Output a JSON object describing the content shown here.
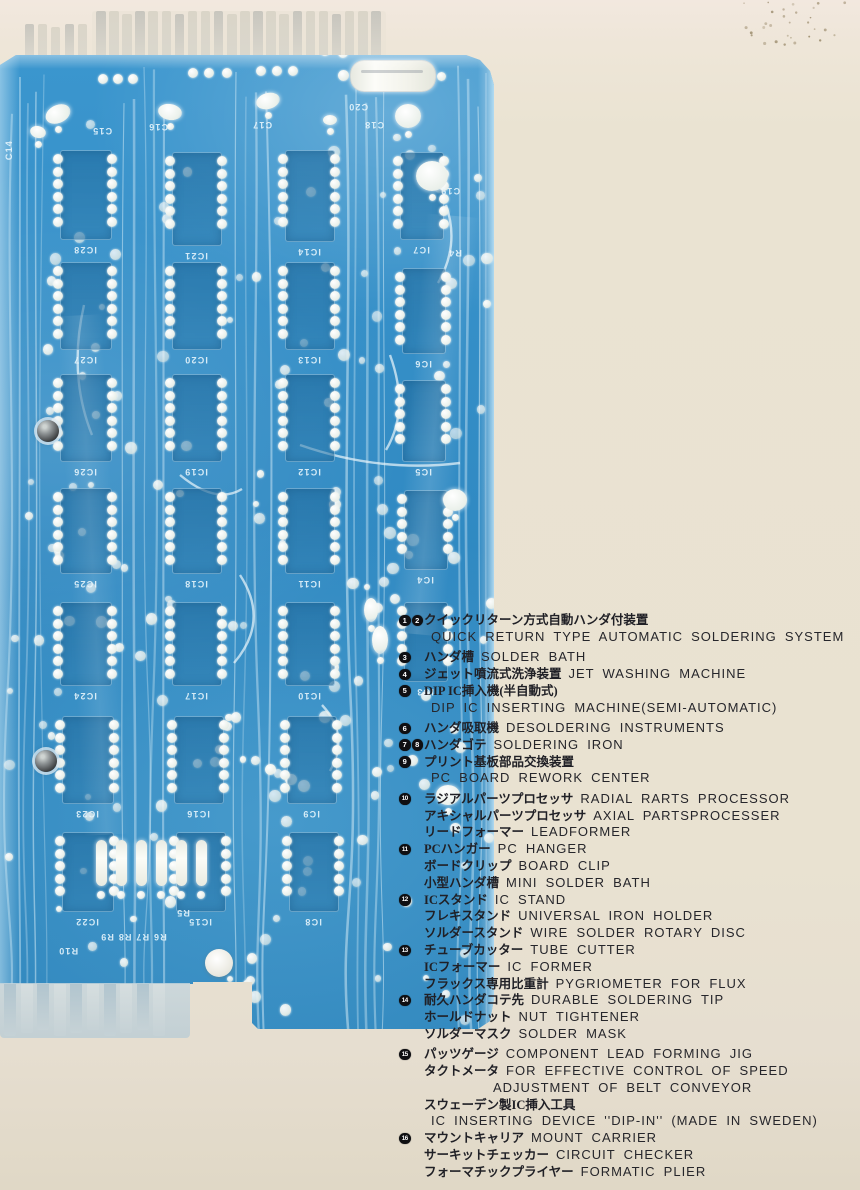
{
  "legend": {
    "lines": [
      {
        "b": [
          1,
          2
        ],
        "jp": "クイックリターン方式自動ハンダ付装置",
        "en": ""
      },
      {
        "b": [],
        "jp": "",
        "en": "QUICK RETURN TYPE AUTOMATIC SOLDERING SYSTEM"
      },
      {
        "b": [
          3
        ],
        "jp": "ハンダ槽",
        "en": "SOLDER BATH",
        "gap": true
      },
      {
        "b": [
          4
        ],
        "jp": "ジェット噴流式洗浄装置",
        "en": "JET WASHING MACHINE"
      },
      {
        "b": [
          5
        ],
        "jp": "DIP IC挿入機(半自動式)",
        "en": ""
      },
      {
        "b": [],
        "jp": "",
        "en": "DIP IC INSERTING MACHINE(SEMI-AUTOMATIC)"
      },
      {
        "b": [
          6
        ],
        "jp": "ハンダ吸取機",
        "en": "DESOLDERING INSTRUMENTS",
        "gap": true
      },
      {
        "b": [
          7,
          8
        ],
        "jp": "ハンダゴテ",
        "en": "SOLDERING IRON"
      },
      {
        "b": [
          9
        ],
        "jp": "プリント基板部品交換装置",
        "en": ""
      },
      {
        "b": [],
        "jp": "",
        "en": "PC BOARD REWORK CENTER"
      },
      {
        "b": [
          10
        ],
        "jp": "ラジアルパーツプロセッサ",
        "en": "RADIAL RARTS PROCESSOR",
        "gap": true
      },
      {
        "b": [],
        "jp": "アキシャルパーツプロセッサ",
        "en": "AXIAL PARTSPROCESSER"
      },
      {
        "b": [],
        "jp": "リードフォーマー",
        "en": "LEADFORMER"
      },
      {
        "b": [
          11
        ],
        "jp": "PCハンガー",
        "en": "PC HANGER"
      },
      {
        "b": [],
        "jp": "ボードクリップ",
        "en": "BOARD CLIP"
      },
      {
        "b": [],
        "jp": "小型ハンダ槽",
        "en": "MINI SOLDER BATH"
      },
      {
        "b": [
          12
        ],
        "jp": "ICスタンド",
        "en": "IC STAND"
      },
      {
        "b": [],
        "jp": "フレキスタンド",
        "en": "UNIVERSAL IRON HOLDER"
      },
      {
        "b": [],
        "jp": "ソルダースタンド",
        "en": "WIRE SOLDER ROTARY DISC"
      },
      {
        "b": [
          13
        ],
        "jp": "チューブカッター",
        "en": "TUBE CUTTER"
      },
      {
        "b": [],
        "jp": "ICフォーマー",
        "en": "IC FORMER"
      },
      {
        "b": [],
        "jp": "フラックス専用比重計",
        "en": "PYGRIOMETER FOR FLUX"
      },
      {
        "b": [
          14
        ],
        "jp": "耐久ハンダコテ先",
        "en": "DURABLE SOLDERING TIP"
      },
      {
        "b": [],
        "jp": "ホールドナット",
        "en": "NUT TIGHTENER"
      },
      {
        "b": [],
        "jp": "ソルダーマスク",
        "en": "SOLDER MASK"
      },
      {
        "b": [
          15
        ],
        "jp": "パッツゲージ",
        "en": "COMPONENT LEAD FORMING JIG",
        "gap": true
      },
      {
        "b": [],
        "jp": "タクトメータ",
        "en": "FOR EFFECTIVE CONTROL OF SPEED"
      },
      {
        "b": [],
        "jp": "",
        "en": "ADJUSTMENT OF BELT CONVEYOR",
        "ind": 1
      },
      {
        "b": [],
        "jp": "スウェーデン製IC挿入工具",
        "en": ""
      },
      {
        "b": [],
        "jp": "",
        "en": "IC INSERTING DEVICE ''DIP-IN'' (MADE IN SWEDEN)"
      },
      {
        "b": [
          16
        ],
        "jp": "マウントキャリア",
        "en": "MOUNT CARRIER"
      },
      {
        "b": [],
        "jp": "サーキットチェッカー",
        "en": "CIRCUIT CHECKER"
      },
      {
        "b": [],
        "jp": "フォーマチックプライヤー",
        "en": "FORMATIC PLIER"
      }
    ]
  },
  "pcb": {
    "board": {
      "left": 0,
      "top": 55,
      "width": 494,
      "height": 982
    },
    "colors": {
      "base": "#3390c9",
      "pad": "#eef4f1",
      "trace": "#d8edf8",
      "silk": "#e8f4fa"
    },
    "ics": [
      {
        "x": 60,
        "y": 150,
        "w": 50,
        "h": 88,
        "label": "IC28"
      },
      {
        "x": 60,
        "y": 262,
        "w": 50,
        "h": 86,
        "label": "IC27"
      },
      {
        "x": 60,
        "y": 374,
        "w": 50,
        "h": 86,
        "label": "IC26"
      },
      {
        "x": 60,
        "y": 488,
        "w": 50,
        "h": 84,
        "label": "IC25"
      },
      {
        "x": 60,
        "y": 602,
        "w": 50,
        "h": 82,
        "label": "IC24"
      },
      {
        "x": 62,
        "y": 716,
        "w": 50,
        "h": 86,
        "label": "IC23"
      },
      {
        "x": 62,
        "y": 832,
        "w": 50,
        "h": 78,
        "label": "IC22"
      },
      {
        "x": 172,
        "y": 152,
        "w": 48,
        "h": 92,
        "label": "IC21"
      },
      {
        "x": 172,
        "y": 262,
        "w": 48,
        "h": 86,
        "label": "IC20"
      },
      {
        "x": 172,
        "y": 374,
        "w": 48,
        "h": 86,
        "label": "IC19"
      },
      {
        "x": 172,
        "y": 488,
        "w": 48,
        "h": 84,
        "label": "IC18"
      },
      {
        "x": 172,
        "y": 602,
        "w": 48,
        "h": 82,
        "label": "IC17"
      },
      {
        "x": 174,
        "y": 716,
        "w": 48,
        "h": 86,
        "label": "IC16"
      },
      {
        "x": 176,
        "y": 832,
        "w": 48,
        "h": 78,
        "label": "IC15"
      },
      {
        "x": 285,
        "y": 150,
        "w": 48,
        "h": 90,
        "label": "IC14"
      },
      {
        "x": 285,
        "y": 262,
        "w": 48,
        "h": 86,
        "label": "IC13"
      },
      {
        "x": 285,
        "y": 374,
        "w": 48,
        "h": 86,
        "label": "IC12"
      },
      {
        "x": 285,
        "y": 488,
        "w": 48,
        "h": 84,
        "label": "IC11"
      },
      {
        "x": 285,
        "y": 602,
        "w": 48,
        "h": 82,
        "label": "IC10"
      },
      {
        "x": 287,
        "y": 716,
        "w": 48,
        "h": 86,
        "label": "IC9"
      },
      {
        "x": 289,
        "y": 832,
        "w": 48,
        "h": 78,
        "label": "IC8"
      },
      {
        "x": 400,
        "y": 152,
        "w": 42,
        "h": 86,
        "label": "IC7"
      },
      {
        "x": 402,
        "y": 268,
        "w": 42,
        "h": 84,
        "label": "IC6"
      },
      {
        "x": 402,
        "y": 380,
        "w": 42,
        "h": 80,
        "label": "IC5"
      },
      {
        "x": 404,
        "y": 490,
        "w": 42,
        "h": 78,
        "label": "IC4"
      },
      {
        "x": 404,
        "y": 602,
        "w": 42,
        "h": 78,
        "label": "IC3"
      }
    ],
    "labels": [
      {
        "x": 4,
        "y": 140,
        "t": "C14",
        "vert": true
      },
      {
        "x": 92,
        "y": 126,
        "t": "C15"
      },
      {
        "x": 148,
        "y": 122,
        "t": "C16"
      },
      {
        "x": 252,
        "y": 120,
        "t": "C17"
      },
      {
        "x": 364,
        "y": 120,
        "t": "C18"
      },
      {
        "x": 440,
        "y": 186,
        "t": "C19"
      },
      {
        "x": 348,
        "y": 102,
        "t": "C20"
      },
      {
        "x": 448,
        "y": 248,
        "t": "R4"
      },
      {
        "x": 176,
        "y": 908,
        "t": "R5"
      },
      {
        "x": 100,
        "y": 932,
        "t": "R6 R7 R8 R9"
      },
      {
        "x": 58,
        "y": 946,
        "t": "R10"
      }
    ],
    "caps": [
      {
        "x": 58,
        "y": 114,
        "rx": 13,
        "ry": 9,
        "rot": -25
      },
      {
        "x": 38,
        "y": 132,
        "rx": 8,
        "ry": 6,
        "rot": 15
      },
      {
        "x": 170,
        "y": 112,
        "rx": 12,
        "ry": 8,
        "rot": 10
      },
      {
        "x": 268,
        "y": 101,
        "rx": 12,
        "ry": 8,
        "rot": -15
      },
      {
        "x": 330,
        "y": 120,
        "rx": 7,
        "ry": 5,
        "rot": 0
      },
      {
        "x": 408,
        "y": 116,
        "rx": 13,
        "ry": 12,
        "rot": 0
      },
      {
        "x": 432,
        "y": 176,
        "rx": 16,
        "ry": 15,
        "rot": 0
      },
      {
        "x": 455,
        "y": 500,
        "rx": 12,
        "ry": 11,
        "rot": 0
      },
      {
        "x": 448,
        "y": 795,
        "rx": 12,
        "ry": 10,
        "rot": 0
      },
      {
        "x": 380,
        "y": 640,
        "rx": 8,
        "ry": 14,
        "rot": 0
      },
      {
        "x": 371,
        "y": 610,
        "rx": 7,
        "ry": 12,
        "rot": 0
      }
    ],
    "holes": [
      {
        "x": 48,
        "y": 431
      },
      {
        "x": 46,
        "y": 761
      }
    ],
    "resistor": {
      "x": 350,
      "y": 60,
      "w": 84,
      "h": 30
    },
    "top_pads": [
      {
        "x": 98,
        "y": 74
      },
      {
        "x": 113,
        "y": 74
      },
      {
        "x": 128,
        "y": 74
      },
      {
        "x": 188,
        "y": 68
      },
      {
        "x": 204,
        "y": 68
      },
      {
        "x": 222,
        "y": 68
      },
      {
        "x": 256,
        "y": 66
      },
      {
        "x": 272,
        "y": 66
      },
      {
        "x": 288,
        "y": 66
      },
      {
        "x": 320,
        "y": 46
      },
      {
        "x": 338,
        "y": 48
      }
    ],
    "vres_row": {
      "x0": 96,
      "y": 840,
      "count": 6,
      "step": 20,
      "w": 11,
      "h": 46
    },
    "top_fingers": [
      {
        "x": 25,
        "y": 24,
        "count": 5,
        "fw": 9,
        "gap": 4.2,
        "h": 34
      },
      {
        "x": 96,
        "y": 11,
        "count": 22,
        "fw": 9.5,
        "gap": 3.6,
        "h": 47
      }
    ],
    "bottom_fingers": {
      "x": 4,
      "y": 1,
      "count": 10,
      "fw": 12,
      "gap": 4.6,
      "h": 52
    }
  }
}
